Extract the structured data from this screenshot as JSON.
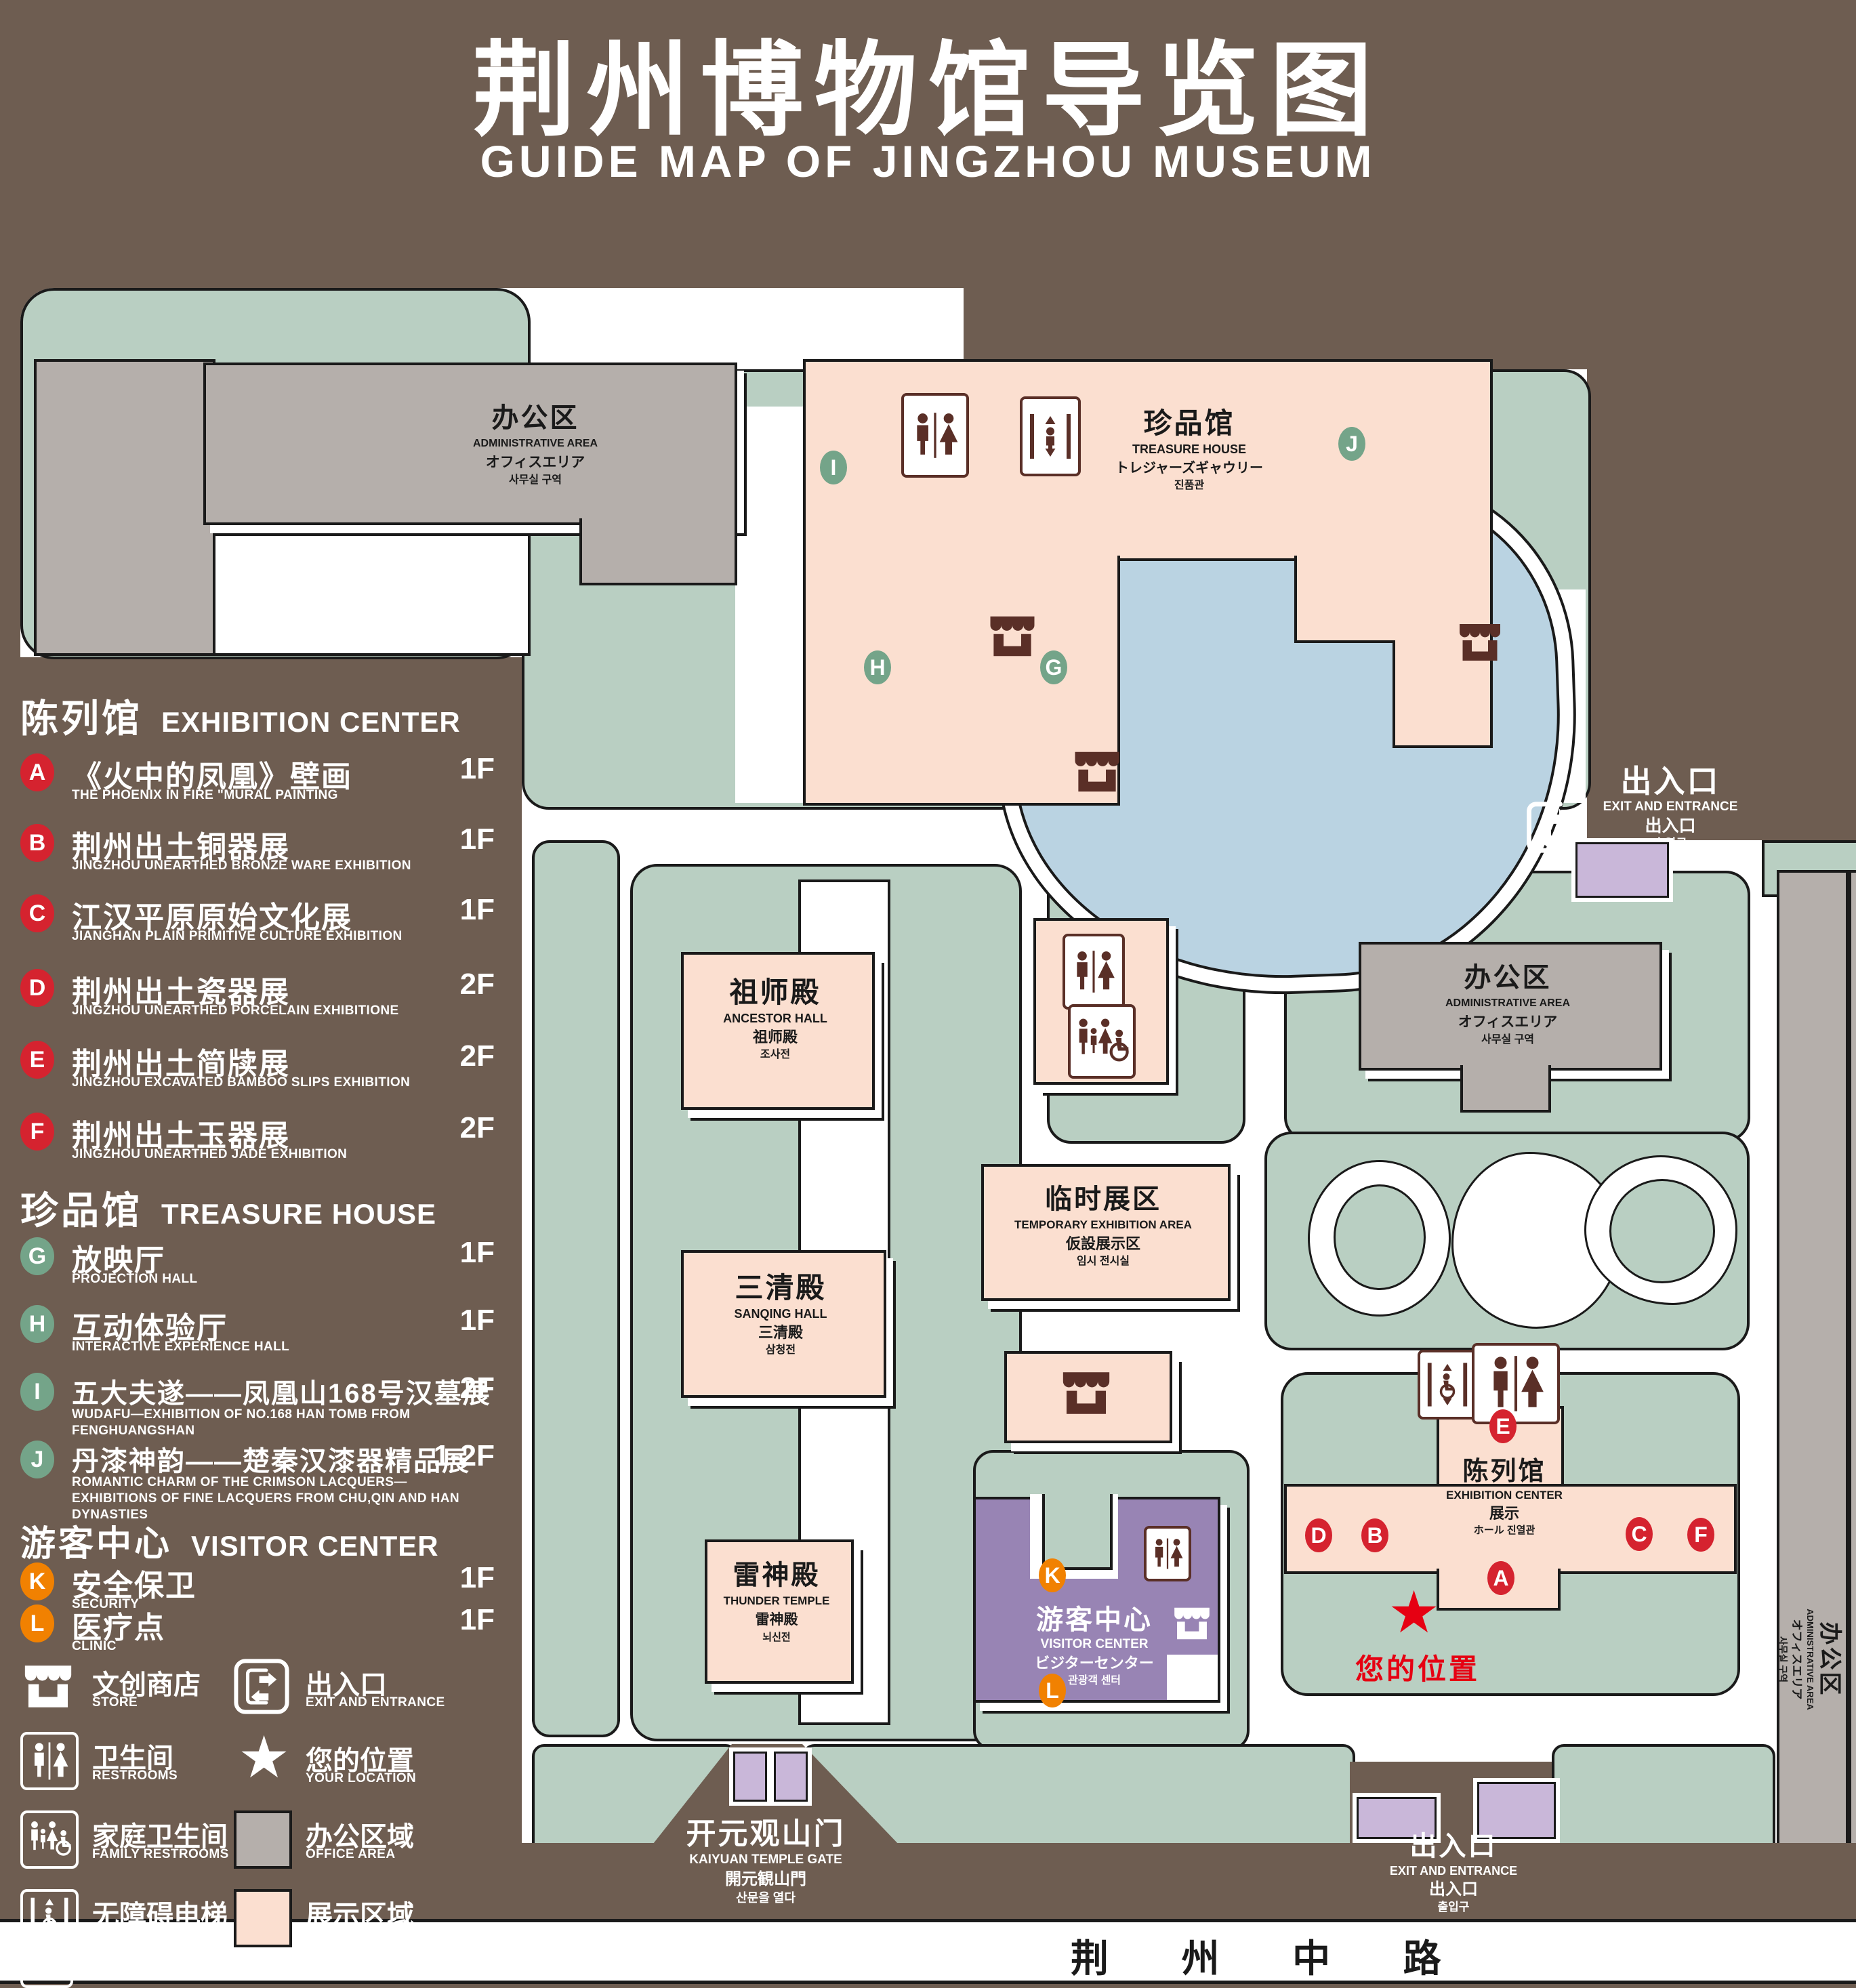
{
  "title": {
    "cn": "荆州博物馆导览图",
    "en": "GUIDE MAP OF JINGZHOU MUSEUM"
  },
  "colors": {
    "background": "#6e5d51",
    "green_area": "#b9cfc2",
    "display_area": "#fbdfd0",
    "office_area": "#b5afab",
    "visitor_center": "#9884b4",
    "pond": "#bad3e2",
    "marker_red": "#d5232f",
    "marker_green": "#74a489",
    "marker_orange": "#f18101",
    "location_red": "#e60012",
    "icon_brown": "#5a2f27"
  },
  "legend": {
    "sections": [
      {
        "header_cn": "陈列馆",
        "header_en": "EXHIBITION CENTER",
        "items": [
          {
            "letter": "A",
            "cn": "《火中的凤凰》壁画",
            "en": "THE PHOENIX IN FIRE \"MURAL PAINTING",
            "floor": "1F"
          },
          {
            "letter": "B",
            "cn": "荆州出土铜器展",
            "en": "JINGZHOU UNEARTHED BRONZE WARE EXHIBITION",
            "floor": "1F"
          },
          {
            "letter": "C",
            "cn": "江汉平原原始文化展",
            "en": "JIANGHAN PLAIN PRIMITIVE CULTURE EXHIBITION",
            "floor": "1F"
          },
          {
            "letter": "D",
            "cn": "荆州出土瓷器展",
            "en": "JINGZHOU UNEARTHED PORCELAIN EXHIBITIONE",
            "floor": "2F"
          },
          {
            "letter": "E",
            "cn": "荆州出土简牍展",
            "en": "JINGZHOU EXCAVATED BAMBOO SLIPS EXHIBITION",
            "floor": "2F"
          },
          {
            "letter": "F",
            "cn": "荆州出土玉器展",
            "en": "JINGZHOU UNEARTHED JADE EXHIBITION",
            "floor": "2F"
          }
        ]
      },
      {
        "header_cn": "珍品馆",
        "header_en": "TREASURE HOUSE",
        "items": [
          {
            "letter": "G",
            "cn": "放映厅",
            "en": "PROJECTION HALL",
            "floor": "1F"
          },
          {
            "letter": "H",
            "cn": "互动体验厅",
            "en": "INTERACTIVE EXPERIENCE HALL",
            "floor": "1F"
          },
          {
            "letter": "I",
            "cn": "五大夫遂——凤凰山168号汉墓展",
            "en": "WUDAFU—EXHIBITION OF NO.168 HAN TOMB FROM FENGHUANGSHAN",
            "floor": "2F"
          },
          {
            "letter": "J",
            "cn": "丹漆神韵——楚秦汉漆器精品展",
            "en": "ROMANTIC CHARM OF THE CRIMSON LACQUERS—EXHIBITIONS OF FINE LACQUERS FROM CHU,QIN AND HAN DYNASTIES",
            "floor": "1-2F"
          }
        ]
      },
      {
        "header_cn": "游客中心",
        "header_en": "VISITOR CENTER",
        "items": [
          {
            "letter": "K",
            "cn": "安全保卫",
            "en": "SECURITY",
            "floor": "1F"
          },
          {
            "letter": "L",
            "cn": "医疗点",
            "en": "CLINIC",
            "floor": "1F"
          }
        ]
      }
    ],
    "symbols": [
      {
        "icon": "store-icon",
        "cn": "文创商店",
        "en": "STORE"
      },
      {
        "icon": "restrooms-icon",
        "cn": "卫生间",
        "en": "RESTROOMS"
      },
      {
        "icon": "family-restrooms-icon",
        "cn": "家庭卫生间",
        "en": "FAMILY RESTROOMS"
      },
      {
        "icon": "accessible-elevator-icon",
        "cn": "无障碍电梯",
        "en": "ACCESSIBLE  ELEVATOR"
      },
      {
        "icon": "elevator-icon",
        "cn": "电梯",
        "en": "Elevator"
      },
      {
        "icon": "exit-icon",
        "cn": "出入口",
        "en": "EXIT AND ENTRANCE"
      },
      {
        "icon": "location-star-icon",
        "cn": "您的位置",
        "en": "YOUR LOCATION"
      },
      {
        "icon": "office-swatch",
        "cn": "办公区域",
        "en": "OFFICE AREA"
      },
      {
        "icon": "display-swatch",
        "cn": "展示区域",
        "en": "DISPLAY AREA"
      }
    ]
  },
  "map": {
    "admin_top": {
      "lines": [
        "办公区",
        "ADMINISTRATIVE AREA",
        "オフィスエリア",
        "사무실 구역"
      ]
    },
    "admin_right": {
      "lines": [
        "办公区",
        "ADMINISTRATIVE AREA",
        "オフィスエリア",
        "사무실 구역"
      ]
    },
    "admin_strip": {
      "lines": [
        "办公区",
        "ADMINISTRATIVE AREA",
        "オフィスエリア",
        "사무실 구역"
      ]
    },
    "treasure_house": {
      "lines": [
        "珍品馆",
        "TREASURE HOUSE",
        "トレジャーズギャウリー",
        "진품관"
      ]
    },
    "ancestor_hall": {
      "lines": [
        "祖师殿",
        "ANCESTOR HALL",
        "祖师殿",
        "조사전"
      ]
    },
    "sanqing_hall": {
      "lines": [
        "三清殿",
        "SANQING HALL",
        "三清殿",
        "삼청전"
      ]
    },
    "thunder_temple": {
      "lines": [
        "雷神殿",
        "THUNDER TEMPLE",
        "雷神殿",
        "뇌신전"
      ]
    },
    "temporary_exhibition": {
      "lines": [
        "临时展区",
        "TEMPORARY EXHIBITION AREA",
        "仮設展示区",
        "임시 전시실"
      ]
    },
    "exhibition_center": {
      "lines": [
        "陈列馆",
        "EXHIBITION CENTER",
        "展示",
        "ホール 진열관"
      ]
    },
    "visitor_center": {
      "lines": [
        "游客中心",
        "VISITOR CENTER",
        "ビジターセンター",
        "관광객 센터"
      ]
    },
    "gate": {
      "lines": [
        "开元观山门",
        "KAIYUAN TEMPLE GATE",
        "開元観山門",
        "산문을 열다"
      ]
    },
    "exit_top": {
      "lines": [
        "出入口",
        "EXIT AND ENTRANCE",
        "出入口",
        "출입구"
      ]
    },
    "exit_bottom": {
      "lines": [
        "出入口",
        "EXIT AND ENTRANCE",
        "出入口",
        "출입구"
      ]
    },
    "road": "荆 州 中 路",
    "your_location": "您的位置",
    "markers": [
      {
        "letter": "I"
      },
      {
        "letter": "J"
      },
      {
        "letter": "H"
      },
      {
        "letter": "G"
      },
      {
        "letter": "E"
      },
      {
        "letter": "D"
      },
      {
        "letter": "B"
      },
      {
        "letter": "C"
      },
      {
        "letter": "F"
      },
      {
        "letter": "A"
      },
      {
        "letter": "K"
      },
      {
        "letter": "L"
      }
    ]
  }
}
